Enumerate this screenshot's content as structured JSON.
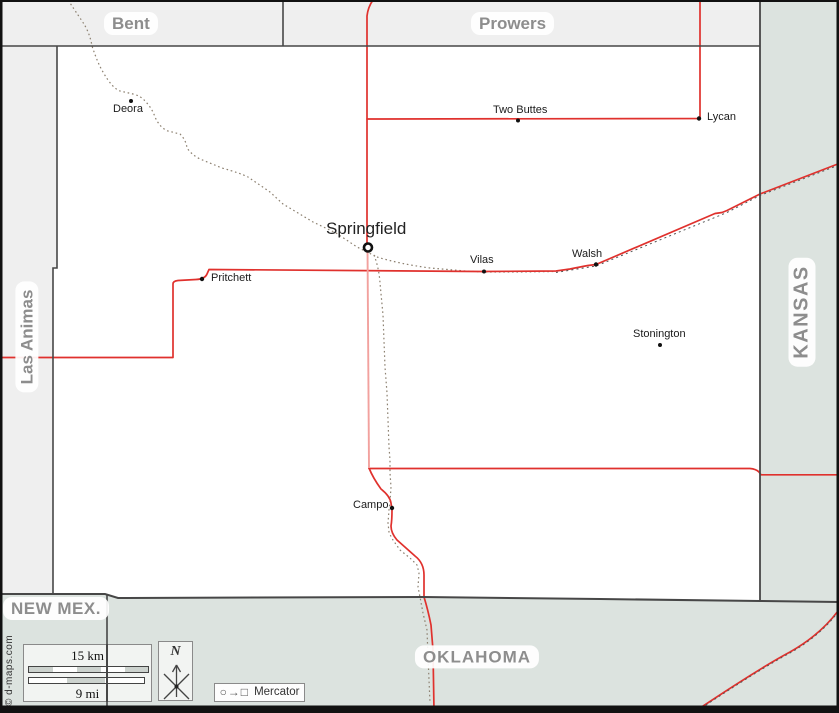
{
  "map": {
    "counties": [
      {
        "name": "Bent"
      },
      {
        "name": "Prowers"
      },
      {
        "name": "Las Animas"
      }
    ],
    "states": [
      {
        "name": "KANSAS"
      },
      {
        "name": "NEW MEX."
      },
      {
        "name": "OKLAHOMA"
      }
    ],
    "towns": [
      {
        "name": "Deora"
      },
      {
        "name": "Two Buttes"
      },
      {
        "name": "Lycan"
      },
      {
        "name": "Springfield",
        "type": "county seat"
      },
      {
        "name": "Vilas"
      },
      {
        "name": "Walsh"
      },
      {
        "name": "Pritchett"
      },
      {
        "name": "Stonington"
      },
      {
        "name": "Campo"
      }
    ],
    "scale": {
      "km_label": "15 km",
      "mi_label": "9 mi"
    },
    "north_label": "N",
    "projection": {
      "glyphs": "○→□",
      "name": "Mercator"
    },
    "credit": "© d-maps.com",
    "colors": {
      "road_major": "#e0312d",
      "road_light": "#f2a19e",
      "neighbor_county_fill": "#efefef",
      "state_fill": "#dce3df",
      "border": "#474747",
      "trail": "#8c8070",
      "region_label": "#8d8d8d"
    }
  }
}
